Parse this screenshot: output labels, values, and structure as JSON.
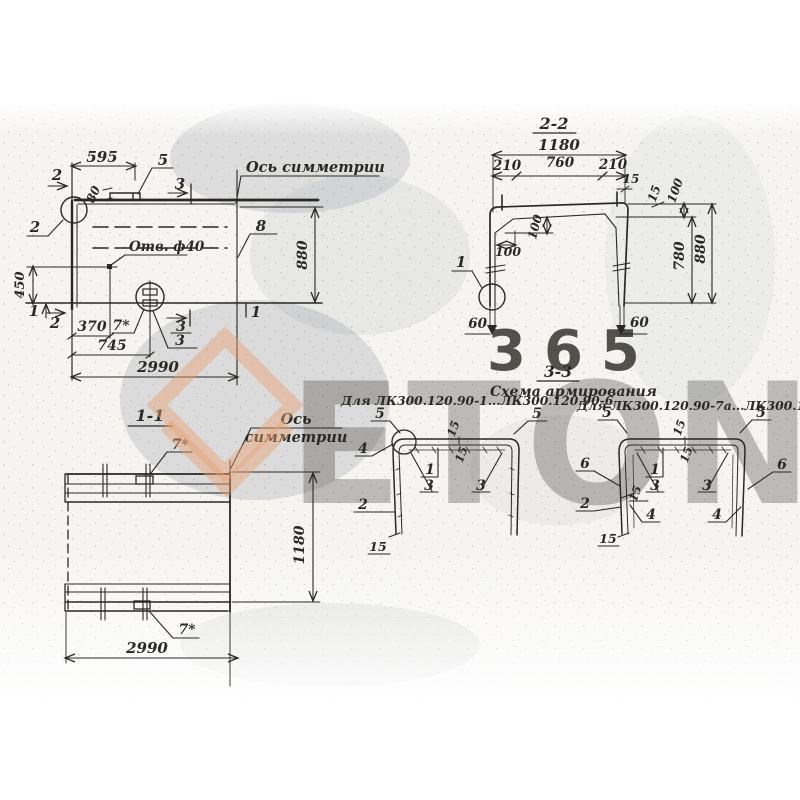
{
  "colors": {
    "ink": "#2a2924",
    "orange": "#e9a172",
    "tint": "#9aa0a5",
    "paper": "#ffffff"
  },
  "watermark": {
    "brand": "ETON",
    "number": "365"
  },
  "plan": {
    "axis": "Ось симметрии",
    "hole": "Отв. ф40",
    "d595": "595",
    "d80": "80",
    "d450": "450",
    "d370": "370",
    "d745": "745",
    "d2990": "2990",
    "d880": "880",
    "m2t": "2",
    "m2c": "2",
    "m2b": "2",
    "m1l": "1",
    "m1r": "1",
    "m3t": "3",
    "m3b": "3",
    "m3h": "3",
    "m5": "5",
    "m7": "7*",
    "m8": "8"
  },
  "s22": {
    "title": "2-2",
    "d1180": "1180",
    "d210l": "210",
    "d760": "760",
    "d210r": "210",
    "d15r": "15",
    "d15c": "15",
    "d100r": "100",
    "d100v": "100",
    "d100h": "100",
    "d780": "780",
    "d880": "880",
    "d60l": "60",
    "d60r": "60",
    "m1": "1"
  },
  "s11": {
    "title": "1-1",
    "axis1": "Ось",
    "axis2": "симметрии",
    "d1180": "1180",
    "d2990": "2990",
    "m7t": "7*",
    "m7b": "7*"
  },
  "s33": {
    "title": "3-3",
    "subtitle": "Схема армирования",
    "capL": "Для ЛК300.120.90-1...ЛК300.120.90-6",
    "capR": "Для ЛК300.120.90-7а...ЛК300.120.90-10а",
    "L": {
      "m5a": "5",
      "m5b": "5",
      "m4": "4",
      "m15t": "15",
      "m15i": "15",
      "m1": "1",
      "m3a": "3",
      "m3b": "3",
      "m2": "2",
      "m15b": "15"
    },
    "R": {
      "m5a": "5",
      "m5b": "5",
      "m15t": "15",
      "m15i": "15",
      "m1": "1",
      "m3a": "3",
      "m3b": "3",
      "m6a": "6",
      "m6b": "6",
      "m2": "2",
      "m4a": "4",
      "m4b": "4",
      "m15m": "15",
      "m15b": "15"
    }
  }
}
